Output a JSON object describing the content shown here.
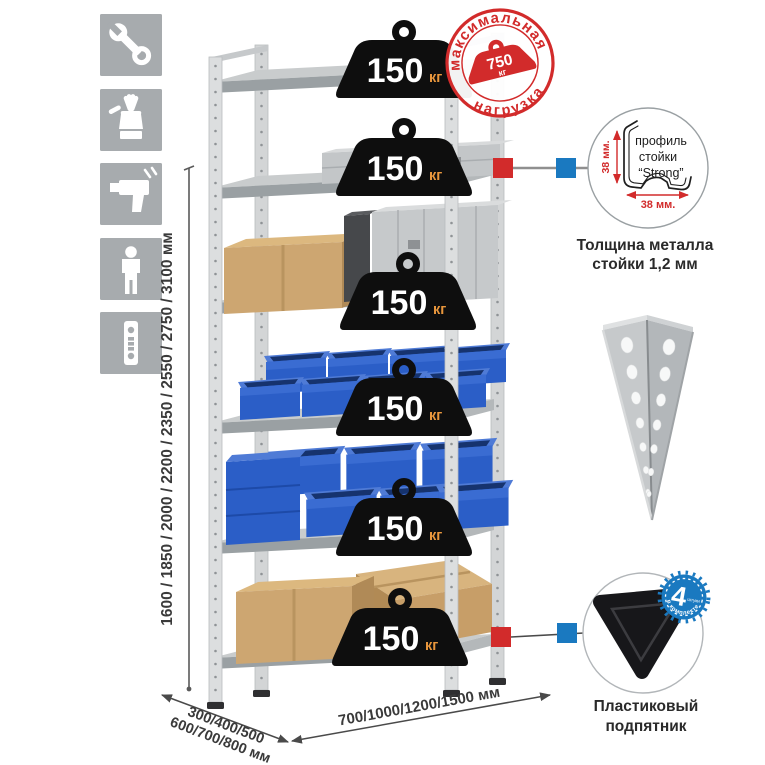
{
  "page": {
    "background": "#ffffff"
  },
  "left_toolbar": {
    "icons": [
      "wrench-icon",
      "work-gloves-icon",
      "drill-icon",
      "person-icon",
      "perforated-profile-icon"
    ]
  },
  "height_dimension": {
    "label": "1600 / 1850 / 2000 / 2200 / 2350 / 2550 / 2750 / 3100 мм"
  },
  "rack": {
    "shelf_count": 6,
    "badges": [
      {
        "value": "150",
        "unit": "кг"
      },
      {
        "value": "150",
        "unit": "кг"
      },
      {
        "value": "150",
        "unit": "кг"
      },
      {
        "value": "150",
        "unit": "кг"
      },
      {
        "value": "150",
        "unit": "кг"
      },
      {
        "value": "150",
        "unit": "кг"
      }
    ]
  },
  "max_load_stamp": {
    "arc_top": "максимальная",
    "arc_bottom": "нагрузка",
    "weight_value": "750",
    "weight_unit": "кг"
  },
  "depth_dimension": {
    "line1": "300/400/500",
    "line2": "600/700/800 мм"
  },
  "width_dimension": {
    "label": "700/1000/1200/1500 мм"
  },
  "profile_detail": {
    "label_line1": "профиль",
    "label_line2": "стойки",
    "label_line3": "“Strong”",
    "dim_vertical": "38 мм.",
    "dim_horizontal": "38 мм.",
    "caption_line1": "Толщина металла",
    "caption_line2": "стойки 1,2 мм"
  },
  "corner_post_image": {
    "name": "perforated-corner-post"
  },
  "foot_detail": {
    "badge_value": "4",
    "badge_caption": "штуки",
    "badge_arc": "в комплекте",
    "caption_line1": "Пластиковый",
    "caption_line2": "подпятник"
  },
  "colors": {
    "accent_red": "#d22b2b",
    "accent_blue": "#1a79c0",
    "badge_black": "#0e0e0e",
    "badge_unit_orange": "#e8963c",
    "bin_blue": "#2b5ec7",
    "metal_light": "#dcdedf",
    "icon_bg": "#a7abae",
    "carton": "#cda671"
  }
}
